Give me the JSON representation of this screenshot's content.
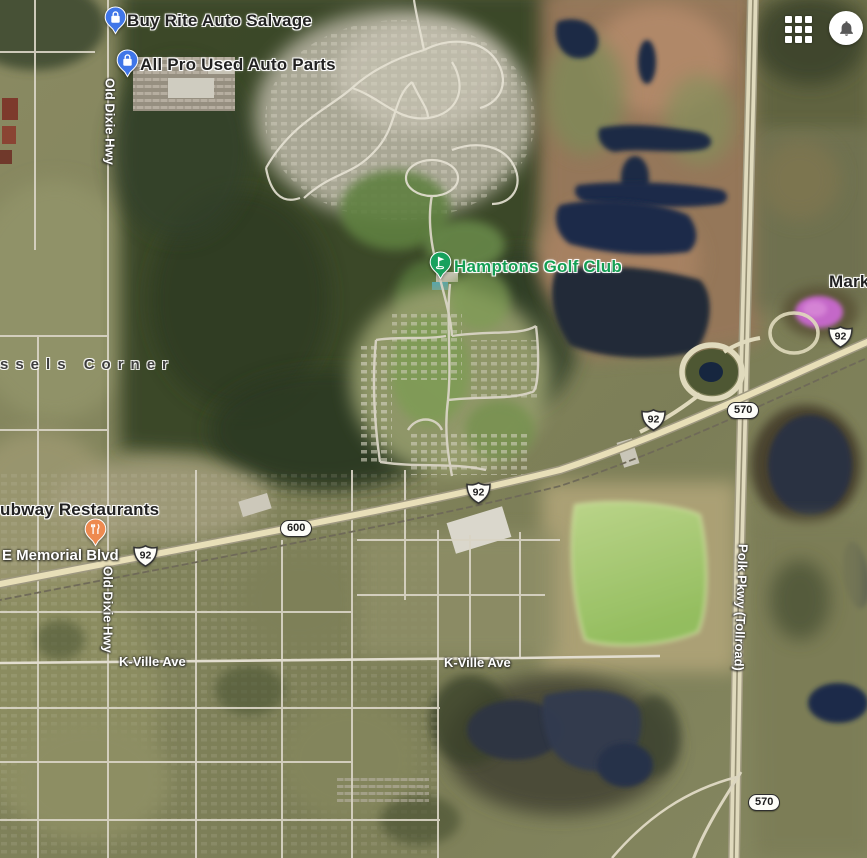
{
  "topbar": {
    "apps_icon": "apps-grid",
    "notifications_icon": "bell"
  },
  "pois": [
    {
      "label": "Buy Rite Auto Salvage",
      "category": "auto-shopping",
      "pin_color": "#4076e8"
    },
    {
      "label": "All Pro Used Auto Parts",
      "category": "auto-shopping",
      "pin_color": "#4076e8"
    },
    {
      "label": "Hamptons Golf Club",
      "category": "golf",
      "pin_color": "#18a15d",
      "label_color": "#149e53"
    },
    {
      "label": "ubway Restaurants",
      "category": "restaurant",
      "pin_color": "#ee8a50"
    },
    {
      "label": "Marke",
      "category": "place-truncated"
    }
  ],
  "localities": [
    {
      "label": "ssels Corner"
    }
  ],
  "road_labels": [
    {
      "text": "Old Dixie Hwy"
    },
    {
      "text": "Old Dixie Hwy"
    },
    {
      "text": "E Memorial Blvd"
    },
    {
      "text": "K-Ville Ave"
    },
    {
      "text": "K-Ville Ave"
    },
    {
      "text": "Polk Pkwy (Tollroad)"
    }
  ],
  "route_shields": [
    {
      "system": "us-route",
      "number": "92"
    },
    {
      "system": "us-route",
      "number": "92"
    },
    {
      "system": "us-route",
      "number": "92"
    },
    {
      "system": "us-route",
      "number": "92"
    },
    {
      "system": "state-road",
      "number": "600"
    },
    {
      "system": "state-road",
      "number": "570"
    },
    {
      "system": "state-road",
      "number": "570"
    }
  ],
  "map_colors": {
    "pin_shopping": "#4076e8",
    "pin_restaurant": "#ee8a50",
    "pin_golf": "#18a15d",
    "golf_label_text": "#149e53",
    "place_label_text": "#212121",
    "road_label_text": "#ffffff",
    "water": "#1e2c48",
    "pink_pond": "#c468c8",
    "green_pond": "#a5c876",
    "forest": "#35422a",
    "marsh": "#9b7a58"
  }
}
